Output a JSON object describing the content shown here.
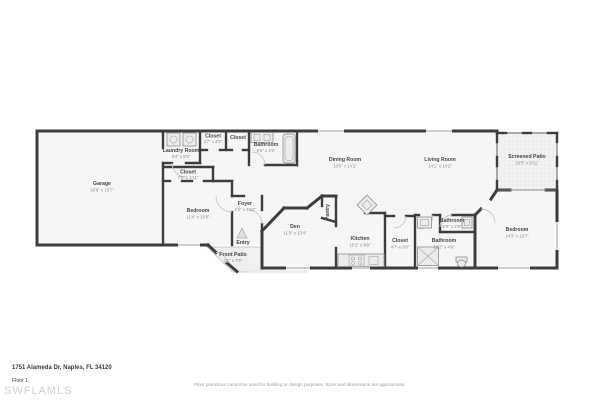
{
  "floorplan": {
    "rooms": {
      "garage": {
        "name": "Garage",
        "dims": "20'8\" x 19'7\""
      },
      "laundry": {
        "name": "Laundry Room",
        "dims": "9'4\" x 6'5\""
      },
      "closet_top_1": {
        "name": "Closet",
        "dims": "2'7\" x 2'2\""
      },
      "closet_top_2": {
        "name": "Closet",
        "dims": ""
      },
      "bathroom_top": {
        "name": "Bathroom",
        "dims": "9'6\" x 4'9\""
      },
      "closet_bedroom": {
        "name": "Closet",
        "dims": "7'6\" x 1'11\""
      },
      "bedroom_left": {
        "name": "Bedroom",
        "dims": "11'4\" x 10'6\""
      },
      "foyer": {
        "name": "Foyer",
        "dims": "4'2\" x 4'10\""
      },
      "entry": {
        "name": "Entry",
        "dims": ""
      },
      "front_patio": {
        "name": "Front Patio",
        "dims": "7'5\" x 7'5\""
      },
      "den": {
        "name": "Den",
        "dims": "11'3\" x 13'4\""
      },
      "pantry": {
        "name": "Pantry",
        "dims": ""
      },
      "dining": {
        "name": "Dining Room",
        "dims": "10'8\" x 14'1\""
      },
      "living": {
        "name": "Living Room",
        "dims": "14'1\" x 14'2\""
      },
      "screened_patio": {
        "name": "Screened Patio",
        "dims": "10'5\" x 9'11\""
      },
      "kitchen": {
        "name": "Kitchen",
        "dims": "10'2\" x 9'9\""
      },
      "closet_walkin": {
        "name": "Closet",
        "dims": "4'7\" x 9'6\""
      },
      "bathroom_small": {
        "name": "Bathroom",
        "dims": "5'9\" x 2'9\""
      },
      "bathroom_main": {
        "name": "Bathroom",
        "dims": "10'2\" x 4'9\""
      },
      "bedroom_right": {
        "name": "Bedroom",
        "dims": "14'3\" x 12'7\""
      }
    },
    "footer": {
      "address": "1751 Alameda Dr, Naples, FL 34120",
      "floor_label": "Floor 1",
      "watermark": "SWFLAMLS",
      "disclaimer": "Floor plans/tour cannot be used for building or design purposes. Sizes and dimensions are approximate."
    },
    "colors": {
      "wall": "#3d3d3d",
      "room_fill": "#f6f6f6",
      "patio_fill": "#f2f2f2",
      "label": "#474747",
      "dims": "#8a8a8a"
    }
  }
}
